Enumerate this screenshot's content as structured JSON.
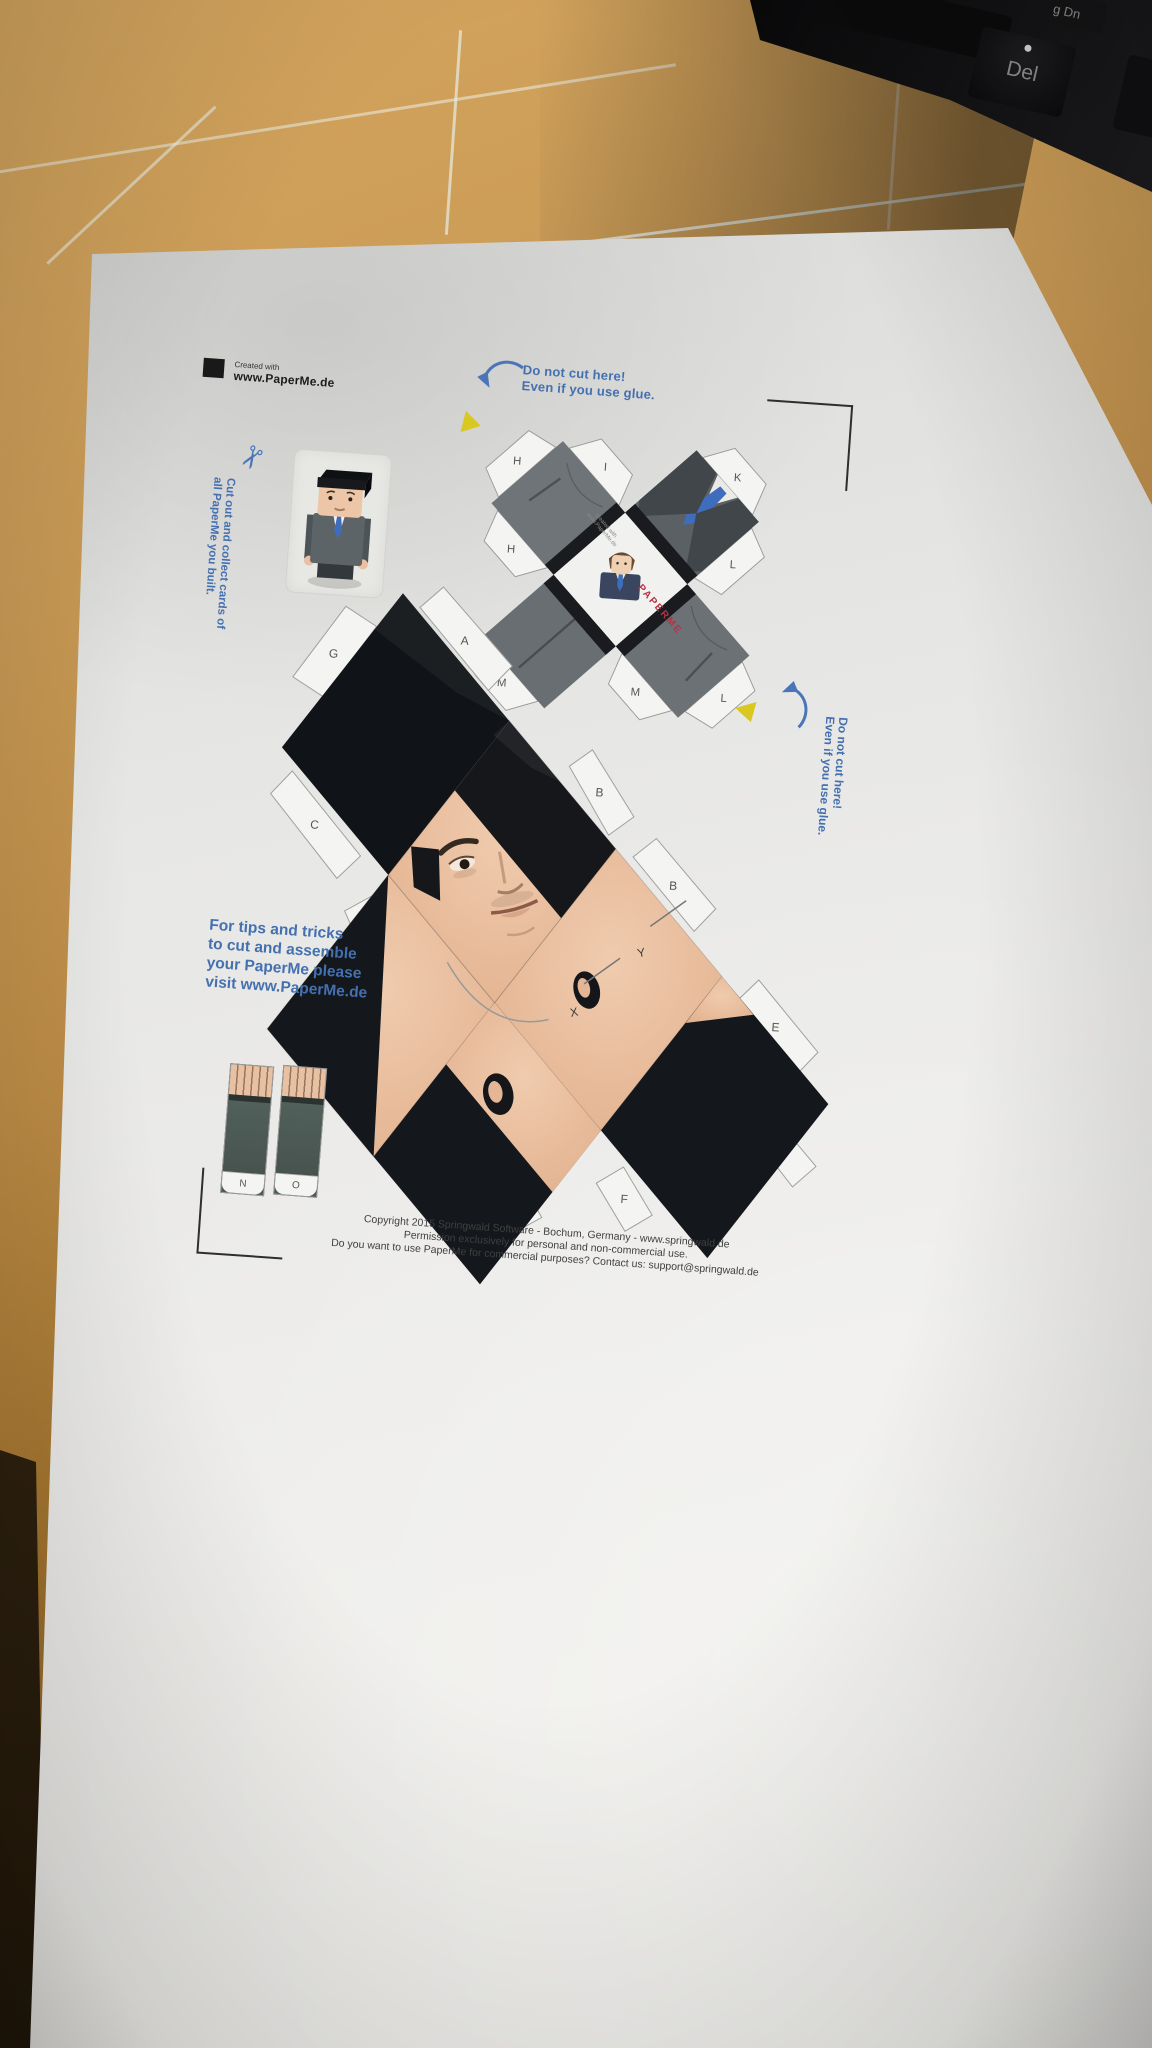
{
  "scene": {
    "keyboard": {
      "keys": [
        {
          "label": "g Dn"
        },
        {
          "label": "Del"
        }
      ]
    }
  },
  "paper": {
    "logo": {
      "created_with": "Created with",
      "site": "www.PaperMe.de"
    },
    "notes": {
      "do_not_cut_top_1": "Do not cut here!",
      "do_not_cut_top_2": "Even if you use glue.",
      "do_not_cut_side_1": "Do not cut here!",
      "do_not_cut_side_2": "Even if you use glue.",
      "collect_1": "Cut out and collect cards of",
      "collect_2": "all PaperMe you built.",
      "tips_1": "For tips and tricks",
      "tips_2": "to cut and assemble",
      "tips_3": "your PaperMe please",
      "tips_4": "visit www.PaperMe.de"
    },
    "card_back": {
      "created_with": "created with",
      "site": "www.PaperMe.de",
      "brand": "PAPERME"
    },
    "body_tabs": {
      "k": "K",
      "i": "I",
      "h1": "H",
      "h2": "H",
      "l1": "L",
      "l2": "L",
      "m1": "M",
      "m2": "M"
    },
    "head_tabs": {
      "g1": "G",
      "a": "A",
      "b1": "B",
      "b2": "B",
      "c": "C",
      "d1": "D",
      "d2": "D",
      "e": "E",
      "f1": "F",
      "f2": "F",
      "g2": "G"
    },
    "arm_tabs": {
      "n": "N",
      "o": "O"
    },
    "panel_marks": {
      "x": "X",
      "y": "Y"
    },
    "footer": {
      "line1": "Copyright 2015 Springwald Software - Bochum, Germany - www.springwald.de",
      "line2": "Permission exclusively for personal and non-commercial use.",
      "line3": "Do you want to use PaperMe for commercial purposes? Contact us: support@springwald.de"
    }
  },
  "colors": {
    "accent_blue": "#4470b0",
    "suit_gray": "#6e7478",
    "skin": "#e9c0a4",
    "mat_green": "#1f5a4b",
    "brand_red": "#b43345",
    "tab_yellow": "#d9c722",
    "tie_blue": "#3f6dbd"
  }
}
